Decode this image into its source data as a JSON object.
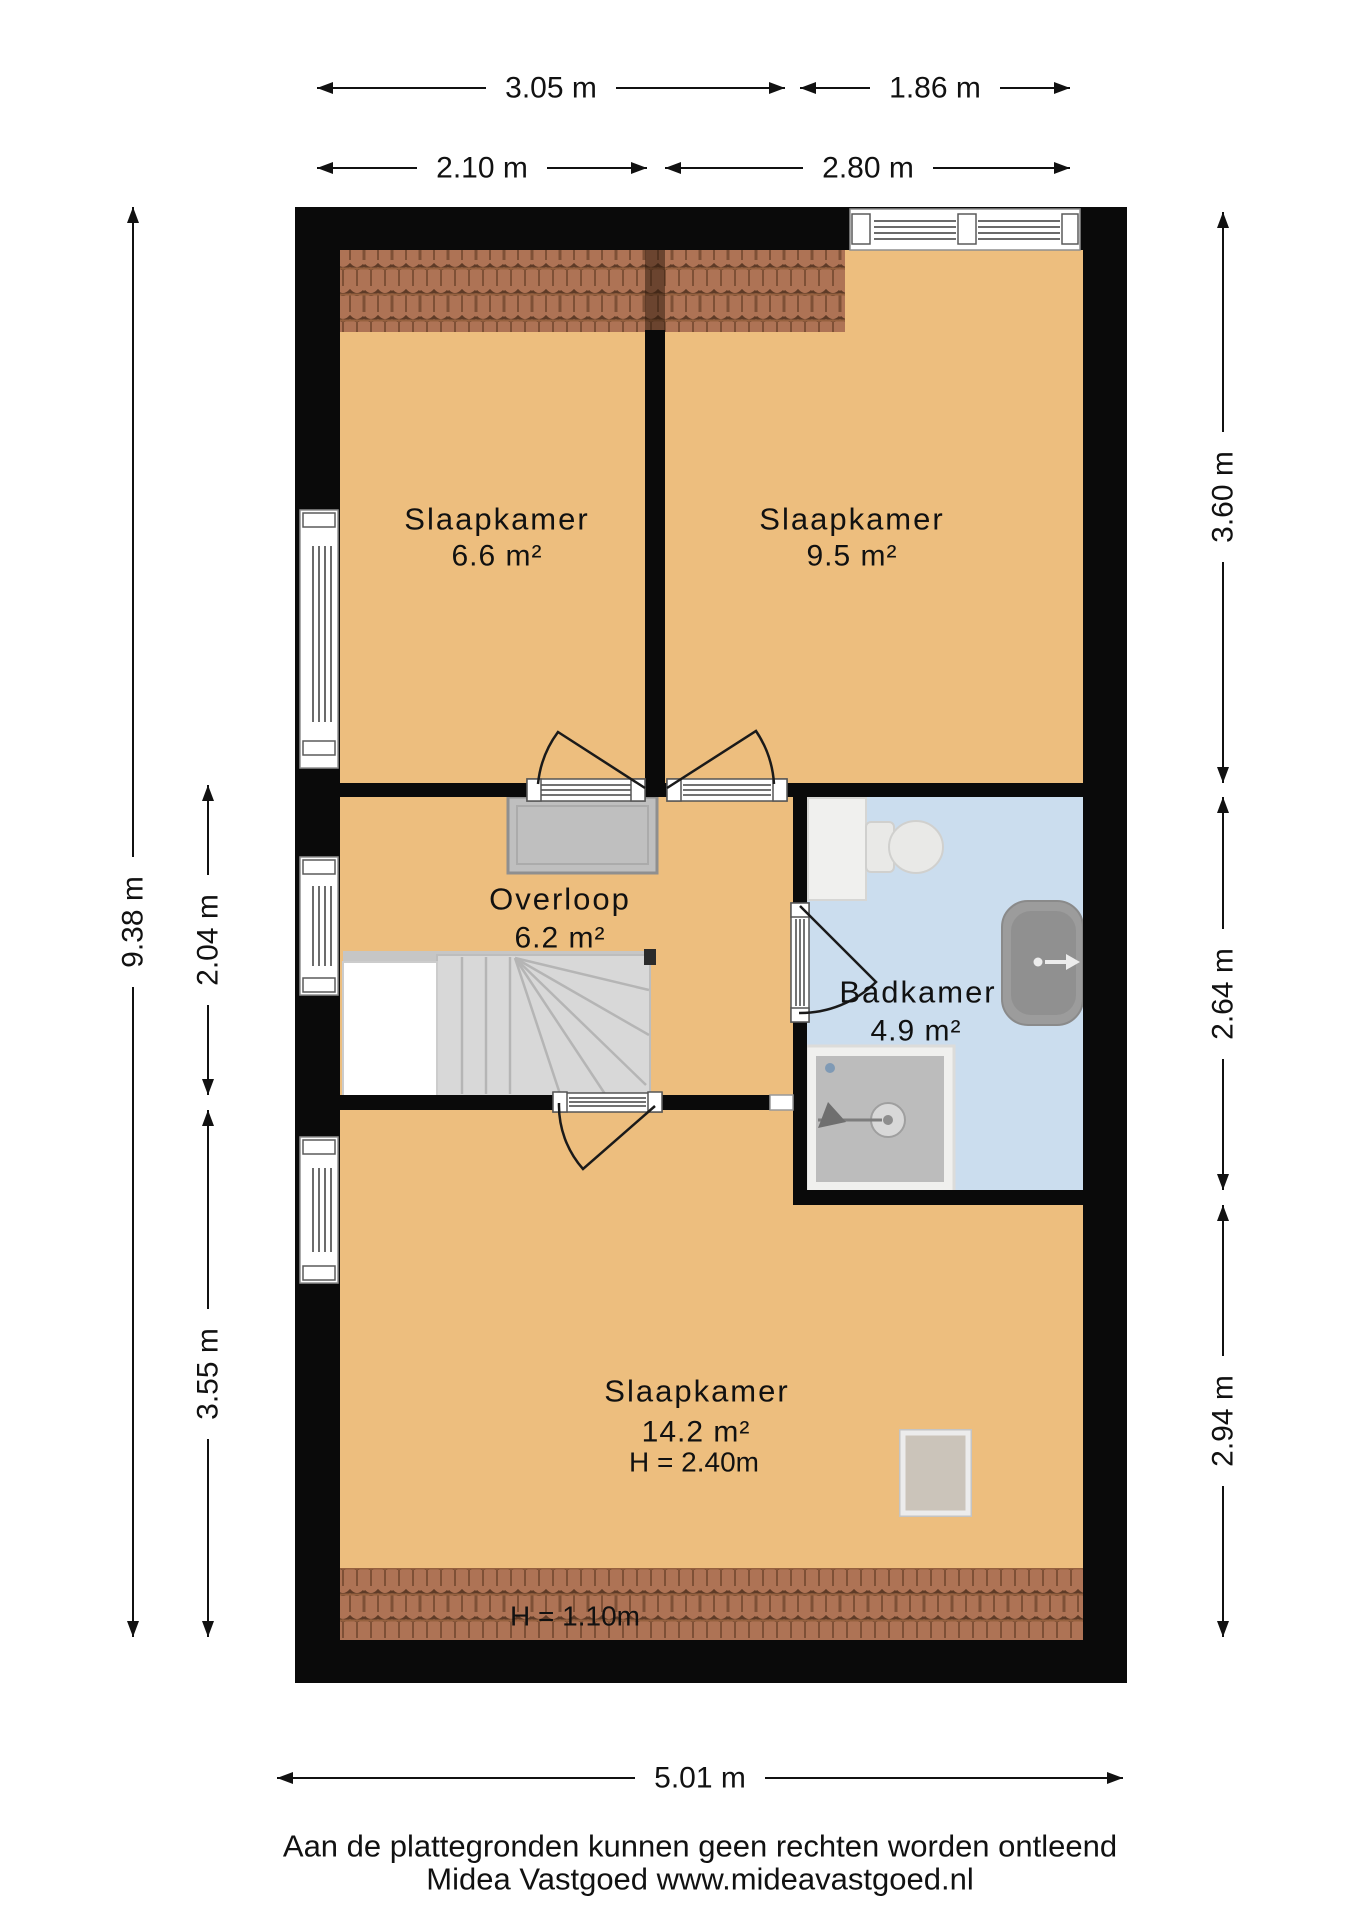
{
  "rooms": {
    "bedroom_top_left": {
      "name": "Slaapkamer",
      "area": "6.6 m²"
    },
    "bedroom_top_right": {
      "name": "Slaapkamer",
      "area": "9.5 m²"
    },
    "landing": {
      "name": "Overloop",
      "area": "6.2 m²"
    },
    "bathroom": {
      "name": "Badkamer",
      "area": "4.9 m²"
    },
    "bedroom_bottom": {
      "name": "Slaapkamer",
      "area": "14.2 m²",
      "ceiling_height": "H = 2.40m"
    }
  },
  "roof_note": "H = 1.10m",
  "dimensions": {
    "top_outer_left": "3.05 m",
    "top_outer_right": "1.86 m",
    "top_inner_left": "2.10 m",
    "top_inner_right": "2.80 m",
    "left_total": "9.38 m",
    "left_landing": "2.04 m",
    "left_bottom": "3.55 m",
    "right_top": "3.60 m",
    "right_middle": "2.64 m",
    "right_bottom": "2.94 m",
    "bottom_total": "5.01 m"
  },
  "footer": {
    "line1": "Aan de plattegronden kunnen geen rechten worden ontleend",
    "line2": "Midea Vastgoed www.mideavastgoed.nl"
  },
  "colors": {
    "floor": "#EDBE7E",
    "bathroom_floor": "#CBDDEE",
    "roof_tiles": "#AE7355",
    "wall": "#0A0A0A",
    "stairs": "#D8D8D8",
    "text": "#111111"
  }
}
